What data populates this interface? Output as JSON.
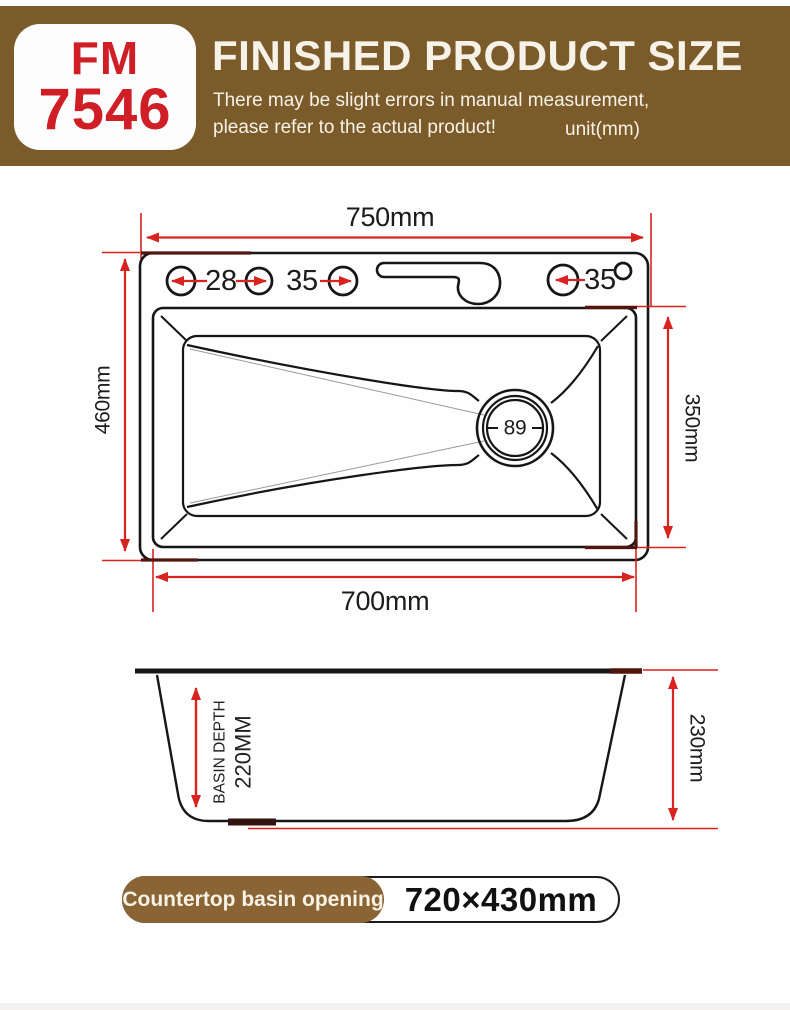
{
  "header": {
    "model_line1": "FM",
    "model_line2": "7546",
    "title": "FINISHED PRODUCT SIZE",
    "subtitle_line1": "There may be slight errors in manual measurement,",
    "subtitle_line2": "please refer to the actual product!",
    "unit_note": "unit(mm)",
    "banner_color": "#7b5b2a",
    "model_text_color": "#cf1e26",
    "banner_text_color": "#f7f2e8"
  },
  "top_view": {
    "overall_width": "750mm",
    "overall_depth": "460mm",
    "bowl_width": "700mm",
    "bowl_depth": "350mm",
    "hole_dim_1": "28",
    "hole_dim_2": "35",
    "hole_dim_3": "35",
    "drain_diameter": "89"
  },
  "side_view": {
    "depth_label": "BASIN DEPTH",
    "depth_value": "220MM",
    "outer_height": "230mm"
  },
  "footer": {
    "label": "Countertop basin opening",
    "value": "720×430mm",
    "label_bg_color": "#8a6434"
  },
  "colors": {
    "dimension_red": "#d8231f",
    "outline_black": "#161616",
    "overlap_maroon": "#51150f"
  }
}
